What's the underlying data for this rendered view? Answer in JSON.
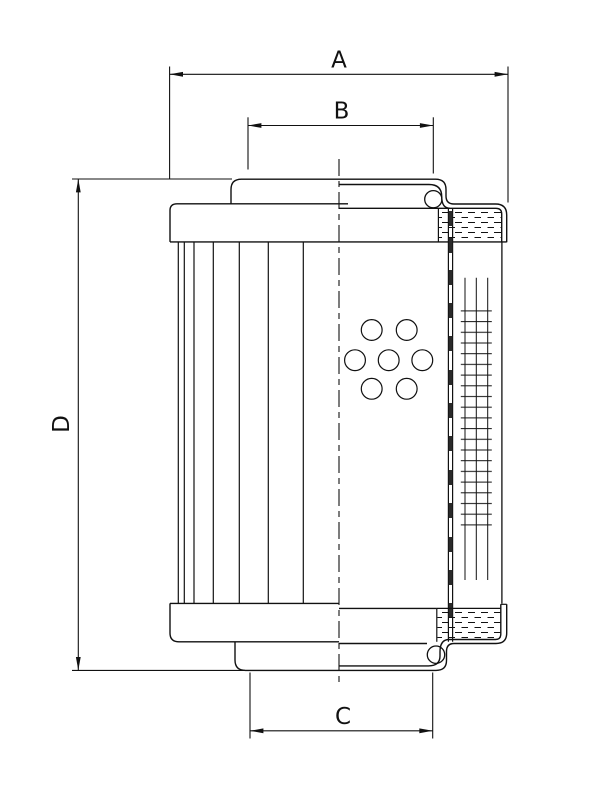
{
  "drawing": {
    "title": "Filter element dimensional drawing",
    "background_color": "#ffffff",
    "line_color": "#111111",
    "dimensions": {
      "a": {
        "label": "A",
        "axis": "horizontal",
        "position": "top-overall-width"
      },
      "b": {
        "label": "B",
        "axis": "horizontal",
        "position": "top-collar-width"
      },
      "c": {
        "label": "C",
        "axis": "horizontal",
        "position": "bottom-collar-width"
      },
      "d": {
        "label": "D",
        "axis": "vertical",
        "position": "left-overall-height"
      }
    }
  }
}
